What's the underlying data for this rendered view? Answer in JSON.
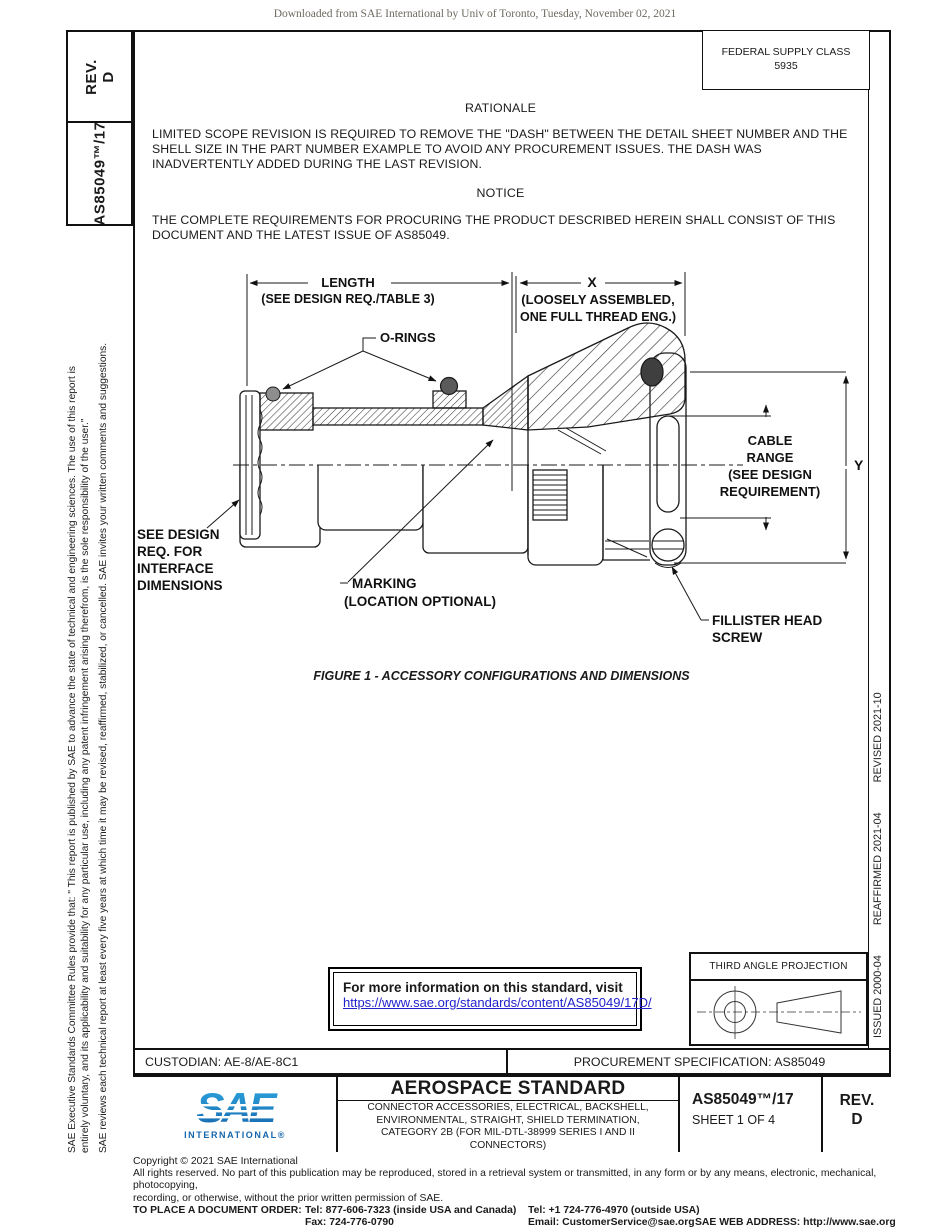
{
  "page_header": {
    "download_notice": "Downloaded from SAE International by Univ of Toronto, Tuesday, November 02, 2021"
  },
  "sidebar_left": {
    "rev_label": "REV.",
    "rev_value": "D",
    "doc_number": "AS85049™/17",
    "legal_line1": "SAE Executive Standards Committee Rules provide that: \" This report is published by SAE to advance the state of technical and engineering sciences. The use of this report is",
    "legal_line2": "entirely voluntary, and its applicability and suitability for any particular use, including any patent infringement arising therefrom, is the sole responsibility of the user.\"",
    "legal_line3": "SAE reviews each technical report at least every five years at which time it may be revised, reaffirmed, stabilized, or cancelled. SAE invites your written comments and suggestions."
  },
  "sidebar_right": {
    "issued": "ISSUED 2000-04",
    "reaffirmed": "REAFFIRMED 2021-04",
    "revised": "REVISED 2021-10"
  },
  "federal_supply": {
    "line1": "FEDERAL SUPPLY CLASS",
    "line2": "5935"
  },
  "rationale": {
    "heading": "RATIONALE",
    "body": "LIMITED SCOPE REVISION IS REQUIRED TO REMOVE THE \"DASH\" BETWEEN THE DETAIL SHEET NUMBER AND THE SHELL SIZE IN THE PART NUMBER EXAMPLE TO AVOID ANY PROCUREMENT ISSUES. THE DASH WAS INADVERTENTLY ADDED DURING THE LAST REVISION."
  },
  "notice": {
    "heading": "NOTICE",
    "body": "THE COMPLETE REQUIREMENTS FOR PROCURING THE PRODUCT DESCRIBED HEREIN SHALL CONSIST OF THIS DOCUMENT AND THE LATEST ISSUE OF AS85049."
  },
  "figure": {
    "caption": "FIGURE 1 - ACCESSORY CONFIGURATIONS AND DIMENSIONS",
    "labels": {
      "length": "LENGTH",
      "length_note": "(SEE DESIGN REQ./TABLE 3)",
      "x_dim": "X",
      "x_note1": "(LOOSELY ASSEMBLED,",
      "x_note2": "ONE FULL THREAD ENG.)",
      "orings": "O-RINGS",
      "cable1": "CABLE",
      "cable2": "RANGE",
      "cable3": "(SEE DESIGN",
      "cable4": "REQUIREMENT)",
      "y_dim": "Y",
      "see1": "SEE DESIGN",
      "see2": "REQ. FOR",
      "see3": "INTERFACE",
      "see4": "DIMENSIONS",
      "marking1": "MARKING",
      "marking2": "(LOCATION OPTIONAL)",
      "fillister1": "FILLISTER HEAD",
      "fillister2": "SCREW"
    }
  },
  "info_box": {
    "line1": "For more information on this standard, visit",
    "link": "https://www.sae.org/standards/content/AS85049/17D/"
  },
  "projection_box": {
    "title": "THIRD ANGLE PROJECTION"
  },
  "custodian_row": {
    "custodian": "CUSTODIAN: AE-8/AE-8C1",
    "procurement": "PROCUREMENT SPECIFICATION: AS85049"
  },
  "title_block": {
    "logo_text": "SAE",
    "logo_sub": "INTERNATIONAL®",
    "title": "AEROSPACE STANDARD",
    "sub1": "CONNECTOR ACCESSORIES, ELECTRICAL, BACKSHELL,",
    "sub2": "ENVIRONMENTAL, STRAIGHT, SHIELD TERMINATION,",
    "sub3": "CATEGORY 2B (FOR MIL-DTL-38999 SERIES I AND II",
    "sub4": "CONNECTORS)",
    "doc_number": "AS85049™/17",
    "sheet": "SHEET 1 OF 4",
    "rev_label": "REV.",
    "rev_value": "D"
  },
  "footer": {
    "copyright": "Copyright © 2021 SAE International",
    "rights1": "All rights reserved. No part of this publication may be reproduced, stored in a retrieval system or transmitted, in any form or by any means, electronic, mechanical, photocopying,",
    "rights2": "recording, or otherwise, without the prior written permission of SAE.",
    "order_label": "TO PLACE A DOCUMENT ORDER:",
    "tel1": "Tel: 877-606-7323 (inside USA and Canada)",
    "tel2": "Tel: +1 724-776-4970 (outside USA)",
    "fax": "Fax: 724-776-0790",
    "email": "Email: CustomerService@sae.org",
    "web": "SAE WEB ADDRESS: http://www.sae.org"
  },
  "colors": {
    "link_blue": "#2222cc",
    "sae_blue_dark": "#1566ac",
    "sae_blue_light": "#2fa8e1"
  }
}
